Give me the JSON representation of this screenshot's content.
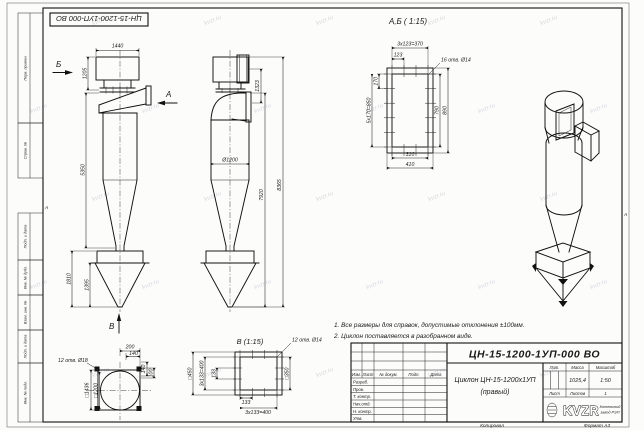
{
  "watermark": {
    "text": "kvzr.ru"
  },
  "frame": {
    "stamp": "ЦН-15-1200-1УП-000 ВО",
    "left_labels": [
      "Перв. примен.",
      "Справ. №",
      "Подп. и дата",
      "Инв. № дубл.",
      "Взам. инв. №",
      "Подп. и дата",
      "Инв. № подл."
    ],
    "zone_left": "А",
    "zone_right": "А",
    "copied": "Копировал",
    "format": "Формат А3"
  },
  "views": {
    "front": {
      "arrow_b": "Б",
      "arrow_a": "А",
      "arrow_v": "В",
      "dim_width": "1440",
      "dim_h1": "1205",
      "dim_h2": "5350",
      "dim_bunker": "1810",
      "dim_cone": "1395"
    },
    "side": {
      "dim_inlet": "1323",
      "dim_dia": "Ø1200",
      "dim_h1": "7920",
      "dim_h2": "8365"
    },
    "section_ab": {
      "title": "А,Б ( 1:15)",
      "dim_top_series": "3х123=370",
      "dim_pitch": "123",
      "holes": "16 отв. Ø14",
      "dim_left_pitch": "170",
      "dim_left_series": "5х170=850",
      "dim_inner_h": "790",
      "dim_outer_h": "890",
      "dim_inner_w": "310",
      "dim_outer_w": "410"
    },
    "view_v": {
      "title": "В (1:15)",
      "holes": "12 отв. Ø14",
      "dim_outer": "□450",
      "dim_series_left": "3х133=400",
      "dim_pitch_left": "133",
      "dim_inner": "□350",
      "dim_pitch_bottom": "133",
      "dim_series_bottom": "3х133=400"
    },
    "flange_bottom": {
      "holes": "12 отв. Ø18",
      "dim_200": "200",
      "dim_140a": "140",
      "dim_140b": "140",
      "dim_100": "100",
      "dim_outer": "□1436",
      "dim_inner": "□1200"
    }
  },
  "notes": {
    "line1": "1. Все размеры для справок, допустимые отклонения ±100мм.",
    "line2": "2. Циклон поставляется в разобранном виде."
  },
  "title_block": {
    "doc_number": "ЦН-15-1200-1УП-000 ВО",
    "name_line1": "Циклон ЦН-15-1200х1УП",
    "name_line2": "(правый)",
    "col_izm": "Изм.",
    "col_list": "Лист",
    "col_doc": "№ докум.",
    "col_podp": "Подп.",
    "col_data": "Дата",
    "rows": [
      "Разраб.",
      "Пров.",
      "Т. контр.",
      "Нач.отд.",
      "Н. контр.",
      "Утв."
    ],
    "lit_label": "Лит.",
    "mass_label": "Масса",
    "scale_label": "Масштаб",
    "mass_value": "1025,4",
    "scale_value": "1:50",
    "sheet_label": "Лист",
    "sheets_label": "Листов",
    "sheets_value": "1",
    "logo_text": "KVZR",
    "org_line1": "Котельный",
    "org_line2": "завод РЭП"
  }
}
